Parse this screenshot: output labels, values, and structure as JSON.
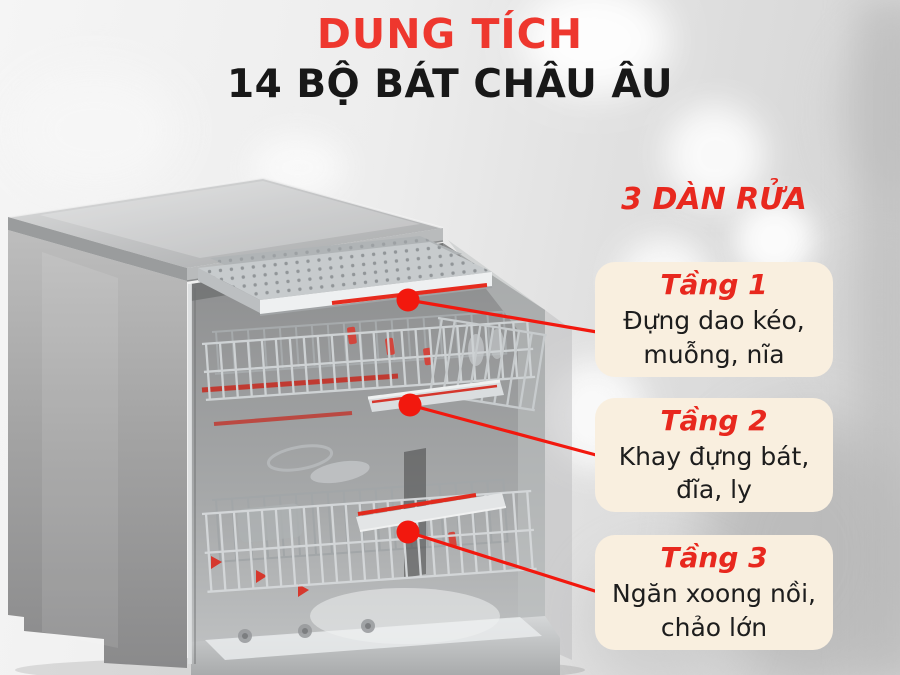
{
  "header": {
    "title": "DUNG TÍCH",
    "subtitle": "14 BỘ BÁT CHÂU ÂU"
  },
  "section": {
    "label": "3 DÀN RỬA"
  },
  "callouts": [
    {
      "tier": "Tầng 1",
      "line1": "Đựng dao kéo,",
      "line2": "muỗng, nĩa"
    },
    {
      "tier": "Tầng 2",
      "line1": "Khay đựng bát,",
      "line2": "đĩa, ly"
    },
    {
      "tier": "Tầng 3",
      "line1": "Ngăn xoong nồi,",
      "line2": "chảo lớn"
    }
  ],
  "colors": {
    "accent_red_text": "#e8281e",
    "title_red": "#ee372e",
    "connector_red": "#f2180e",
    "callout_bg": "#f9efdf",
    "text_dark": "#1d1d1d"
  }
}
